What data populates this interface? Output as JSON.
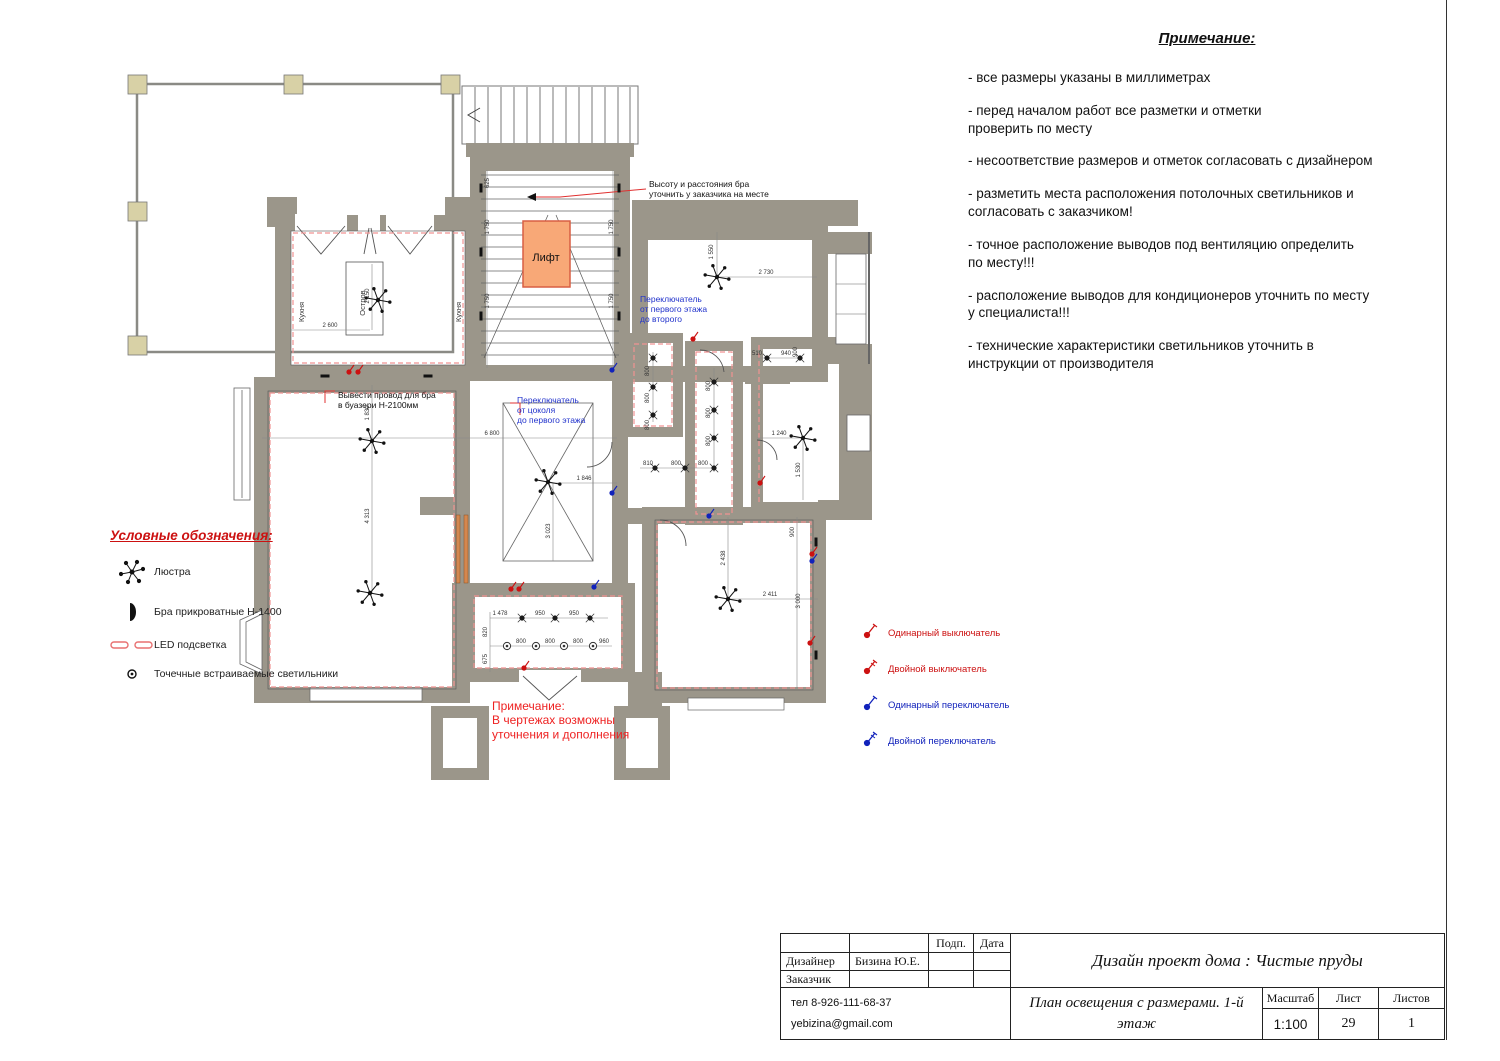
{
  "colors": {
    "wall": "#9b968a",
    "column": "#d8d1a6",
    "lift_fill": "#f8a877",
    "lift_stroke": "#d85f43",
    "led": "#f09292",
    "red_text": "#e03030",
    "blue_text": "#2233cc",
    "switch_red": "#cc1111",
    "switch_blue": "#1122bb"
  },
  "notes": {
    "title": "Примечание:",
    "items": [
      "- все размеры указаны в миллиметрах",
      "- перед началом работ все разметки и отметки\nпроверить по месту",
      "- несоответствие размеров и отметок согласовать с дизайнером",
      "- разметить места расположения потолочных светильников и\nсогласовать с заказчиком!",
      "- точное расположение выводов под вентиляцию определить\nпо месту!!!",
      "- расположение выводов для кондиционеров уточнить по месту\nу специалиста!!!",
      "- технические характеристики светильников уточнить в\nинструкции от производителя"
    ]
  },
  "legend": {
    "title": "Условные обозначения:",
    "items": [
      {
        "icon": "chandelier-icon",
        "label": "Люстра"
      },
      {
        "icon": "sconce-icon",
        "label": "Бра прикроватные Н-1400"
      },
      {
        "icon": "led-strip-icon",
        "label": "LED подсветка"
      },
      {
        "icon": "spotlight-icon",
        "label": "Точечные встраиваемые светильники"
      }
    ]
  },
  "switch_legend": [
    {
      "label": "Одинарный выключатель",
      "color": "#cc1111",
      "type": "single"
    },
    {
      "label": "Двойной выключатель",
      "color": "#cc1111",
      "type": "double"
    },
    {
      "label": "Одинарный переключатель",
      "color": "#1122bb",
      "type": "single"
    },
    {
      "label": "Двойной переключатель",
      "color": "#1122bb",
      "type": "double"
    }
  ],
  "plan": {
    "labels": [
      {
        "lines": [
          "Лифт"
        ],
        "x": 546,
        "y": 261,
        "size": 11,
        "color": "#111",
        "anchor": "middle",
        "rot": 0
      },
      {
        "lines": [
          "Кухня"
        ],
        "x": 304,
        "y": 312,
        "size": 7.5,
        "color": "#333",
        "anchor": "middle",
        "rot": -90
      },
      {
        "lines": [
          "Кухня"
        ],
        "x": 461,
        "y": 312,
        "size": 7.5,
        "color": "#333",
        "anchor": "middle",
        "rot": -90
      },
      {
        "lines": [
          "Остров"
        ],
        "x": 365,
        "y": 303,
        "size": 7.5,
        "color": "#333",
        "anchor": "middle",
        "rot": -90
      },
      {
        "lines": [
          "Высоту и расстояния бра",
          "уточнить у заказчика на месте"
        ],
        "x": 649,
        "y": 187,
        "size": 8.5,
        "color": "#111",
        "anchor": "start",
        "rot": 0
      },
      {
        "lines": [
          "Переключатель",
          "от первого этажа",
          "до второго"
        ],
        "x": 640,
        "y": 302,
        "size": 8.5,
        "color": "#2233cc",
        "anchor": "start",
        "rot": 0
      },
      {
        "lines": [
          "Переключатель",
          "от цоколя",
          "до первого этажа"
        ],
        "x": 517,
        "y": 403,
        "size": 8.5,
        "color": "#2233cc",
        "anchor": "start",
        "rot": 0
      },
      {
        "lines": [
          "Вывести провод для бра",
          "в буазери Н-2100мм"
        ],
        "x": 338,
        "y": 398,
        "size": 8.5,
        "color": "#111",
        "anchor": "start",
        "rot": 0
      },
      {
        "lines": [
          "Примечание:",
          "В чертежах возможны",
          "уточнения и дополнения"
        ],
        "x": 492,
        "y": 710,
        "size": 12,
        "color": "#ee2222",
        "anchor": "start",
        "rot": 0
      }
    ],
    "dimensions": [
      {
        "t": "6 800",
        "x": 492,
        "y": 435,
        "rot": 0
      },
      {
        "t": "1 846",
        "x": 584,
        "y": 480,
        "rot": 0
      },
      {
        "t": "2 730",
        "x": 766,
        "y": 274,
        "rot": 0
      },
      {
        "t": "1 550",
        "x": 713,
        "y": 252,
        "rot": -90
      },
      {
        "t": "2 600",
        "x": 330,
        "y": 327,
        "rot": 0
      },
      {
        "t": "2 150",
        "x": 369,
        "y": 296,
        "rot": -90
      },
      {
        "t": "1 830",
        "x": 369,
        "y": 413,
        "rot": -90
      },
      {
        "t": "4 313",
        "x": 369,
        "y": 516,
        "rot": -90
      },
      {
        "t": "3 023",
        "x": 550,
        "y": 531,
        "rot": -90
      },
      {
        "t": "2 438",
        "x": 725,
        "y": 558,
        "rot": -90
      },
      {
        "t": "2 411",
        "x": 770,
        "y": 596,
        "rot": 0
      },
      {
        "t": "900",
        "x": 794,
        "y": 532,
        "rot": -90
      },
      {
        "t": "3 000",
        "x": 800,
        "y": 601,
        "rot": -90
      },
      {
        "t": "1 240",
        "x": 779,
        "y": 435,
        "rot": 0
      },
      {
        "t": "1 530",
        "x": 800,
        "y": 470,
        "rot": -90
      },
      {
        "t": "800",
        "x": 649,
        "y": 371,
        "rot": -90
      },
      {
        "t": "800",
        "x": 649,
        "y": 398,
        "rot": -90
      },
      {
        "t": "800",
        "x": 649,
        "y": 425,
        "rot": -90
      },
      {
        "t": "800",
        "x": 710,
        "y": 386,
        "rot": -90
      },
      {
        "t": "800",
        "x": 710,
        "y": 413,
        "rot": -90
      },
      {
        "t": "800",
        "x": 710,
        "y": 441,
        "rot": -90
      },
      {
        "t": "810",
        "x": 648,
        "y": 465,
        "rot": 0
      },
      {
        "t": "800",
        "x": 676,
        "y": 465,
        "rot": 0
      },
      {
        "t": "800",
        "x": 703,
        "y": 465,
        "rot": 0
      },
      {
        "t": "510",
        "x": 757,
        "y": 355,
        "rot": 0
      },
      {
        "t": "940",
        "x": 786,
        "y": 355,
        "rot": 0
      },
      {
        "t": "900",
        "x": 797,
        "y": 352,
        "rot": -90
      },
      {
        "t": "1 478",
        "x": 500,
        "y": 615,
        "rot": 0
      },
      {
        "t": "950",
        "x": 540,
        "y": 615,
        "rot": 0
      },
      {
        "t": "950",
        "x": 574,
        "y": 615,
        "rot": 0
      },
      {
        "t": "800",
        "x": 521,
        "y": 643,
        "rot": 0
      },
      {
        "t": "800",
        "x": 550,
        "y": 643,
        "rot": 0
      },
      {
        "t": "800",
        "x": 578,
        "y": 643,
        "rot": 0
      },
      {
        "t": "960",
        "x": 604,
        "y": 643,
        "rot": 0
      },
      {
        "t": "820",
        "x": 487,
        "y": 632,
        "rot": -90
      },
      {
        "t": "675",
        "x": 487,
        "y": 659,
        "rot": -90
      },
      {
        "t": "625",
        "x": 489,
        "y": 183,
        "rot": -90
      },
      {
        "t": "1 750",
        "x": 489,
        "y": 227,
        "rot": -90
      },
      {
        "t": "1 750",
        "x": 489,
        "y": 301,
        "rot": -90
      },
      {
        "t": "1 750",
        "x": 613,
        "y": 227,
        "rot": -90
      },
      {
        "t": "1 750",
        "x": 613,
        "y": 301,
        "rot": -90
      }
    ],
    "chandeliers": [
      [
        378,
        300
      ],
      [
        372,
        441
      ],
      [
        370,
        593
      ],
      [
        548,
        482
      ],
      [
        717,
        277
      ],
      [
        803,
        438
      ],
      [
        728,
        599
      ]
    ],
    "spots_filled": [
      [
        653,
        358
      ],
      [
        653,
        387
      ],
      [
        653,
        415
      ],
      [
        714,
        382
      ],
      [
        714,
        410
      ],
      [
        714,
        438
      ],
      [
        655,
        468
      ],
      [
        685,
        468
      ],
      [
        714,
        468
      ],
      [
        767,
        358
      ],
      [
        800,
        358
      ],
      [
        522,
        618
      ],
      [
        555,
        618
      ],
      [
        590,
        618
      ]
    ],
    "spots_open": [
      [
        507,
        646
      ],
      [
        536,
        646
      ],
      [
        564,
        646
      ],
      [
        593,
        646
      ]
    ],
    "sconces": [
      [
        481,
        188,
        "v"
      ],
      [
        481,
        252,
        "v"
      ],
      [
        481,
        316,
        "v"
      ],
      [
        619,
        188,
        "v"
      ],
      [
        619,
        252,
        "v"
      ],
      [
        619,
        316,
        "v"
      ],
      [
        325,
        376,
        "h"
      ],
      [
        428,
        376,
        "h"
      ],
      [
        816,
        542,
        "v"
      ],
      [
        816,
        655,
        "v"
      ]
    ],
    "switches": [
      {
        "x": 349,
        "y": 372,
        "c": "#cc1111"
      },
      {
        "x": 358,
        "y": 372,
        "c": "#cc1111"
      },
      {
        "x": 511,
        "y": 589,
        "c": "#cc1111"
      },
      {
        "x": 519,
        "y": 589,
        "c": "#cc1111"
      },
      {
        "x": 524,
        "y": 668,
        "c": "#cc1111"
      },
      {
        "x": 693,
        "y": 339,
        "c": "#cc1111"
      },
      {
        "x": 760,
        "y": 483,
        "c": "#cc1111"
      },
      {
        "x": 812,
        "y": 554,
        "c": "#cc1111"
      },
      {
        "x": 810,
        "y": 643,
        "c": "#cc1111"
      },
      {
        "x": 612,
        "y": 370,
        "c": "#1122bb"
      },
      {
        "x": 612,
        "y": 493,
        "c": "#1122bb"
      },
      {
        "x": 709,
        "y": 516,
        "c": "#1122bb"
      },
      {
        "x": 812,
        "y": 561,
        "c": "#1122bb"
      },
      {
        "x": 594,
        "y": 587,
        "c": "#1122bb"
      }
    ],
    "lift_label": "Лифт"
  },
  "titleblock": {
    "podp": "Подп.",
    "data": "Дата",
    "designer_label": "Дизайнер",
    "designer_name": "Бизина Ю.Е.",
    "client_label": "Заказчик",
    "phone": "тел 8-926-111-68-37",
    "email": "yebizina@gmail.com",
    "project_title": "Дизайн проект дома : Чистые пруды",
    "sheet_title": "План освещения с размерами. 1-й\nэтаж",
    "scale_label": "Масштаб",
    "scale_value": "1:100",
    "sheet_label": "Лист",
    "sheet_value": "29",
    "sheets_label": "Листов",
    "sheets_value": "1"
  }
}
